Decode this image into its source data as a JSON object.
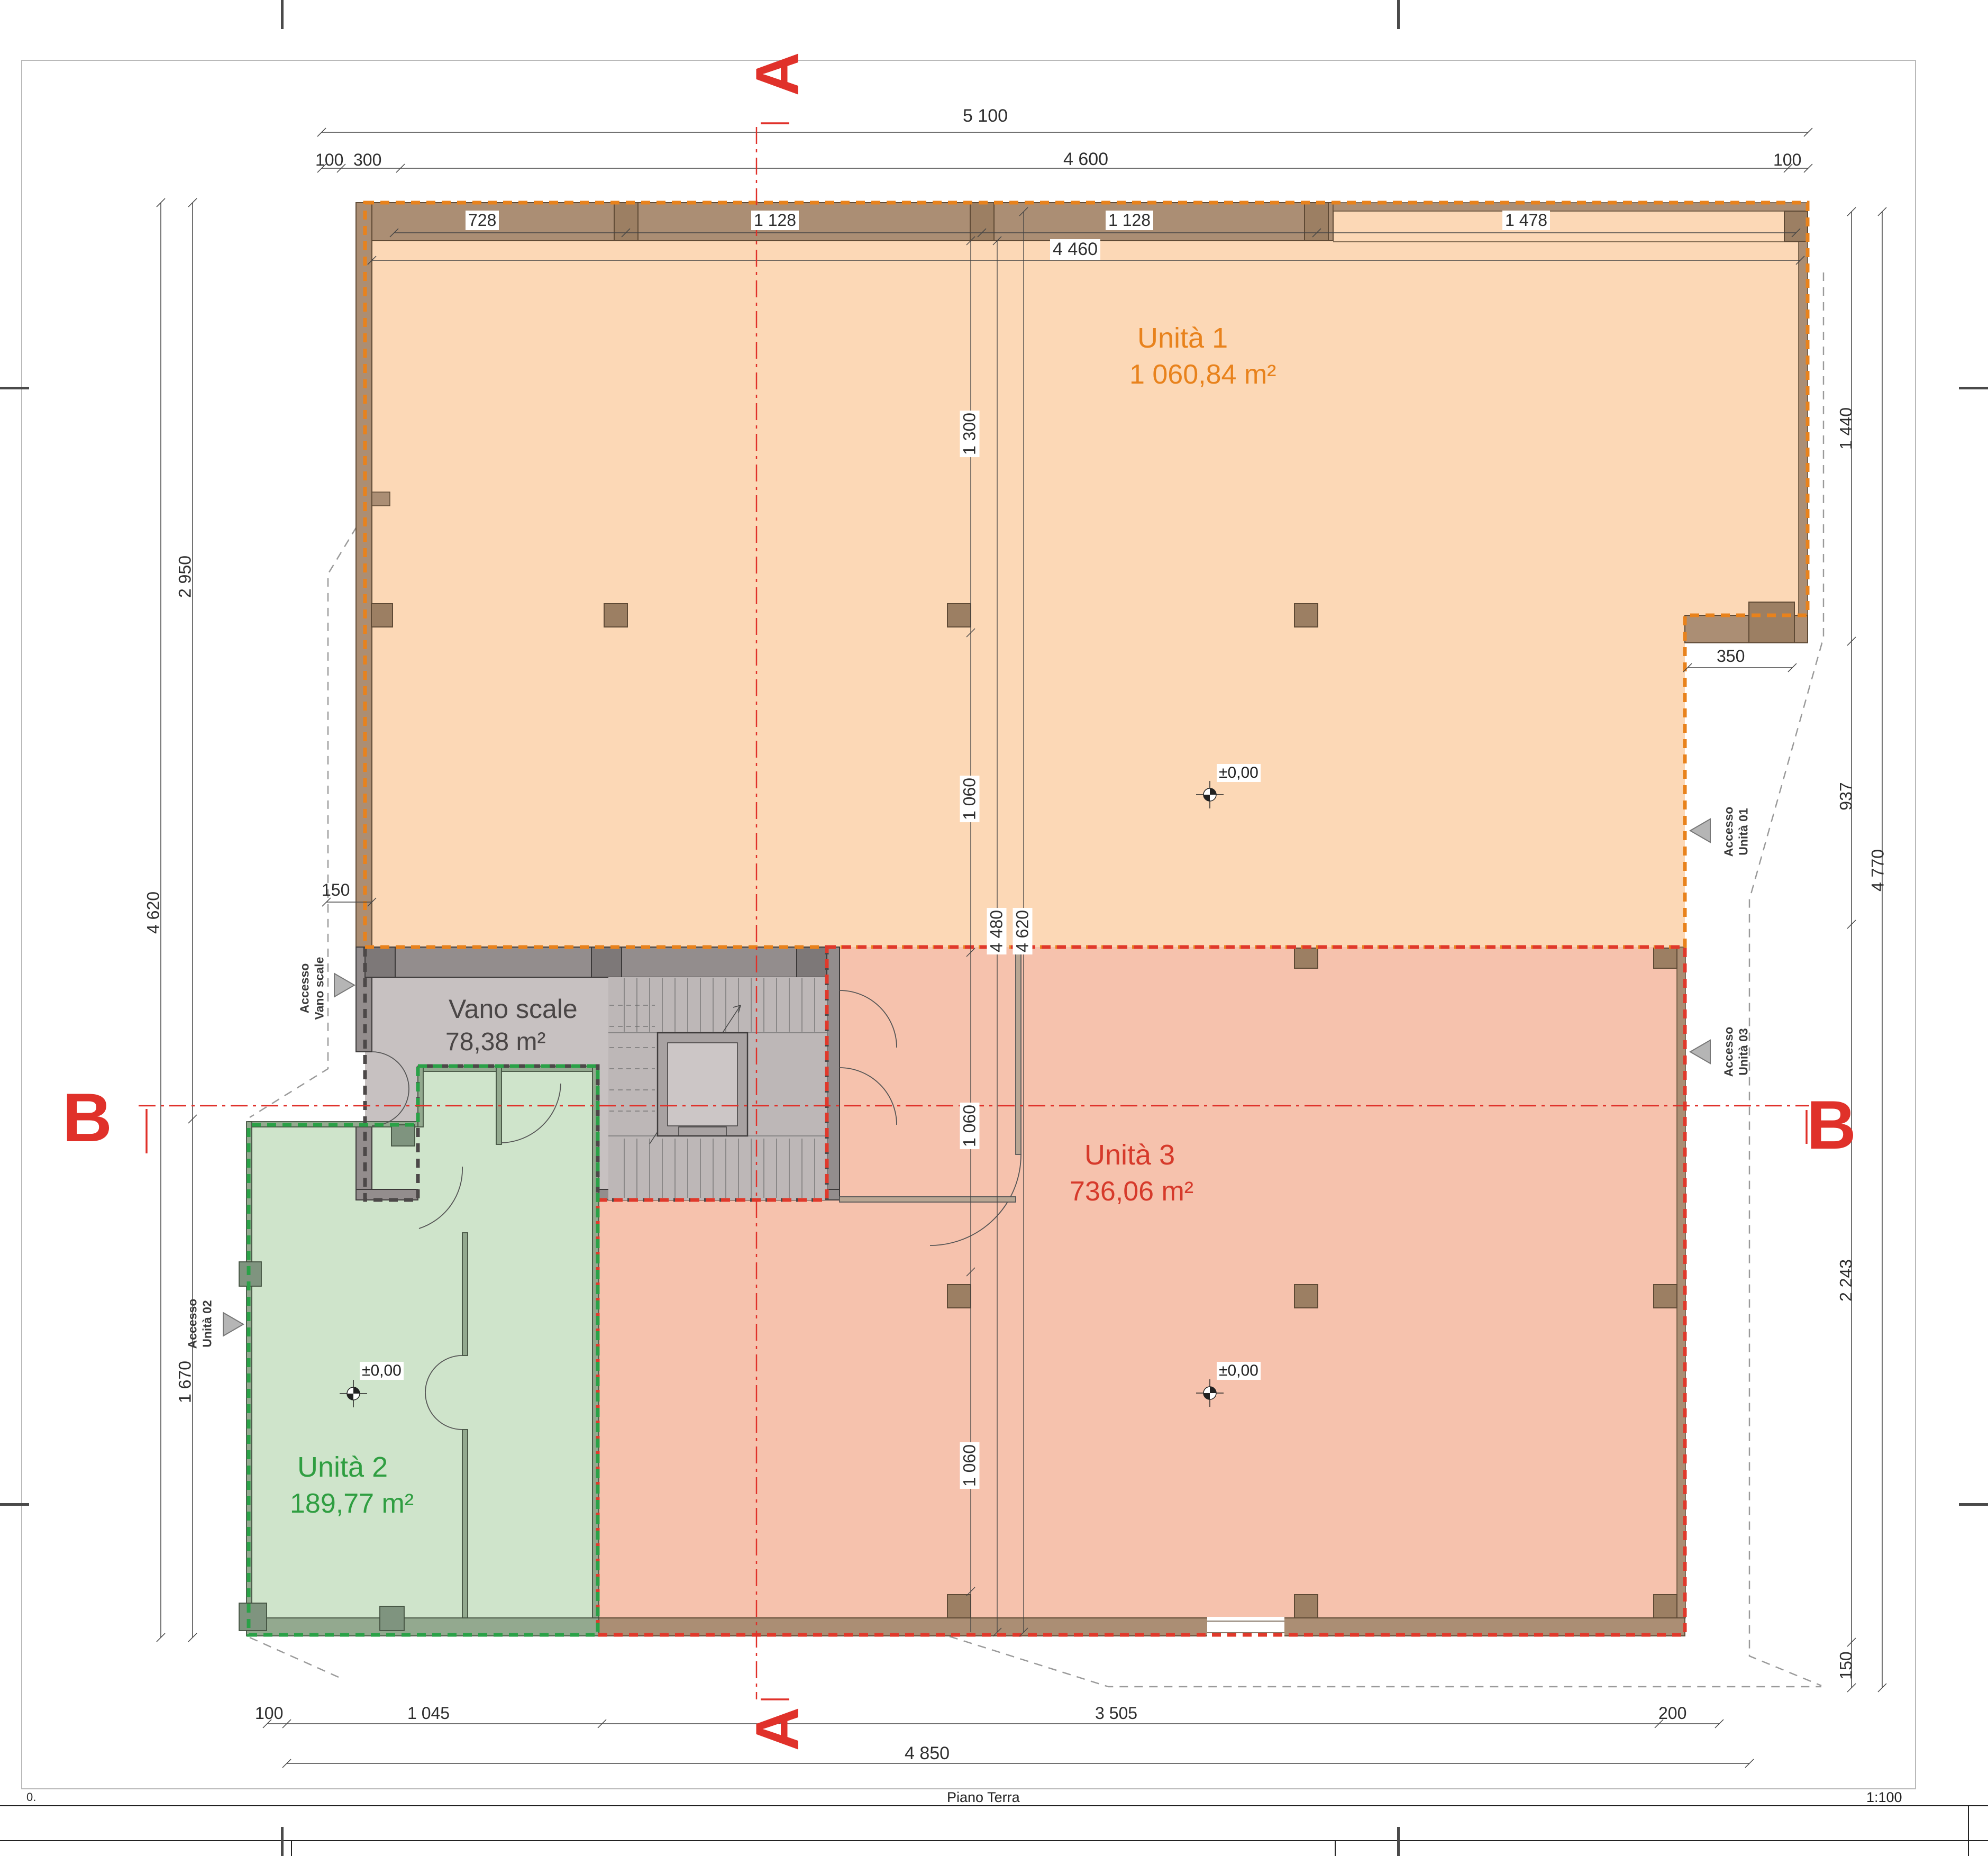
{
  "drawing": {
    "title": "Piano Terra",
    "scale": "1:100",
    "sheet_number": "0."
  },
  "section_markers": {
    "a": "A",
    "b": "B"
  },
  "units": {
    "unit1": {
      "name": "Unità 1",
      "area": "1 060,84 m²",
      "color": "#e8821c"
    },
    "unit2": {
      "name": "Unità 2",
      "area": "189,77 m²",
      "color": "#2f9e41"
    },
    "unit3": {
      "name": "Unità 3",
      "area": "736,06 m²",
      "color": "#d63a2b"
    },
    "vano_scale": {
      "name": "Vano scale",
      "area": "78,38 m²",
      "color": "#4a4646"
    }
  },
  "levels": {
    "ground": "±0,00"
  },
  "access": {
    "vano": {
      "line1": "Accesso",
      "line2": "Vano scale"
    },
    "u01": {
      "line1": "Accesso",
      "line2": "Unità 01"
    },
    "u02": {
      "line1": "Accesso",
      "line2": "Unità 02"
    },
    "u03": {
      "line1": "Accesso",
      "line2": "Unità 03"
    }
  },
  "dims": {
    "top": {
      "overall": "5 100",
      "seg100L": "100",
      "seg300": "300",
      "seg4600": "4 600",
      "seg100R": "100",
      "bay728": "728",
      "bay1128a": "1 128",
      "bay1128b": "1 128",
      "bay1478": "1 478",
      "inner4460": "4 460"
    },
    "left": {
      "d2950": "2 950",
      "d4620": "4 620",
      "d1670": "1 670",
      "d150": "150"
    },
    "right": {
      "d1440": "1 440",
      "d937": "937",
      "d350": "350",
      "d4770": "4 770",
      "d2243": "2 243",
      "d150": "150"
    },
    "bottom": {
      "d100": "100",
      "d1045": "1 045",
      "d3505": "3 505",
      "d200": "200",
      "d4850": "4 850"
    },
    "interior": {
      "d1300": "1 300",
      "d1060a": "1 060",
      "d1060b": "1 060",
      "d1060c": "1 060",
      "d4480": "4 480",
      "d4620": "4 620"
    }
  },
  "colors": {
    "unit1_fill": "#fcd8b6",
    "unit2_fill": "#cfe4cb",
    "unit3_fill": "#f6c2ad",
    "vano_fill": "#c7c1c1",
    "wall_brown": "#ab8e74",
    "section_red": "#e0312a",
    "dim_line": "#444444"
  }
}
